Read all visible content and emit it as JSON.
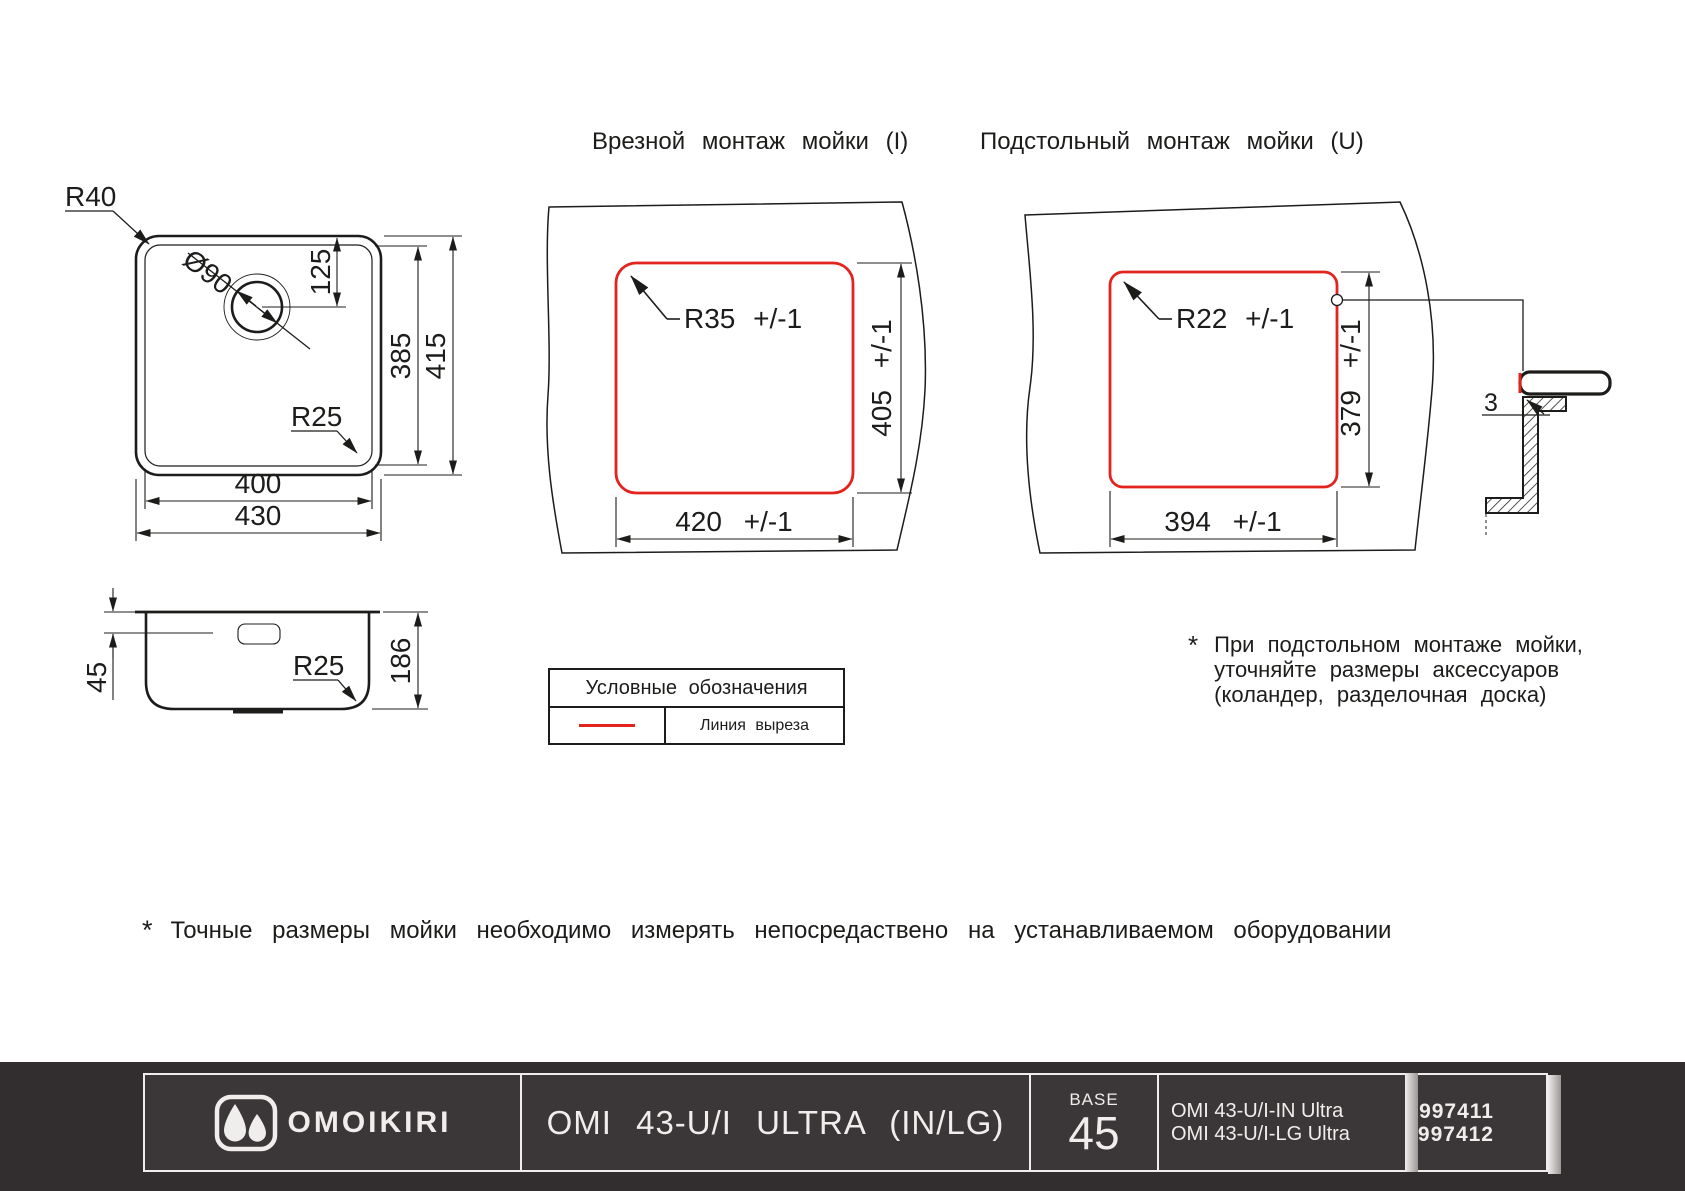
{
  "colors": {
    "line": "#1c1c1a",
    "cut_line": "#e3231e",
    "footer_band": "#322d2e",
    "footer_panel": "#3b3637",
    "footer_border": "#f0eeec"
  },
  "titles": {
    "inset": "Врезной монтаж мойки (I)",
    "undermount": "Подстольный монтаж мойки (U)"
  },
  "top_view": {
    "corner_radius": "R40",
    "hole_diameter": "Ø90",
    "hole_offset": "125",
    "inner_height": "385",
    "outer_height": "415",
    "bottom_radius": "R25",
    "inner_width": "400",
    "outer_width": "430"
  },
  "side_view": {
    "rim_height": "45",
    "bottom_radius": "R25",
    "depth": "186"
  },
  "inset_cutout": {
    "radius": "R35 +/-1",
    "height": "405 +/-1",
    "width": "420 +/-1"
  },
  "undermount_cutout": {
    "radius": "R22 +/-1",
    "height": "379 +/-1",
    "width": "394 +/-1",
    "edge_gap": "3"
  },
  "legend": {
    "title": "Условные обозначения",
    "cut_line_label": "Линия выреза"
  },
  "notes": {
    "star": "*",
    "undermount": [
      "При подстольном монтаже мойки,",
      "уточняйте размеры аксессуаров",
      "(коландер, разделочная доска)"
    ],
    "bottom": "Точные размеры мойки необходимо измерять непосредаствено на устанавливаемом оборудовании"
  },
  "footer": {
    "brand": "OMOIKIRI",
    "model": "OMI 43-U/I ULTRA (IN/LG)",
    "base_label": "BASE",
    "base_value": "45",
    "items": [
      {
        "name": "OMI 43-U/I-IN Ultra",
        "code": "4997411"
      },
      {
        "name": "OMI 43-U/I-LG Ultra",
        "code": "4997412"
      }
    ]
  }
}
